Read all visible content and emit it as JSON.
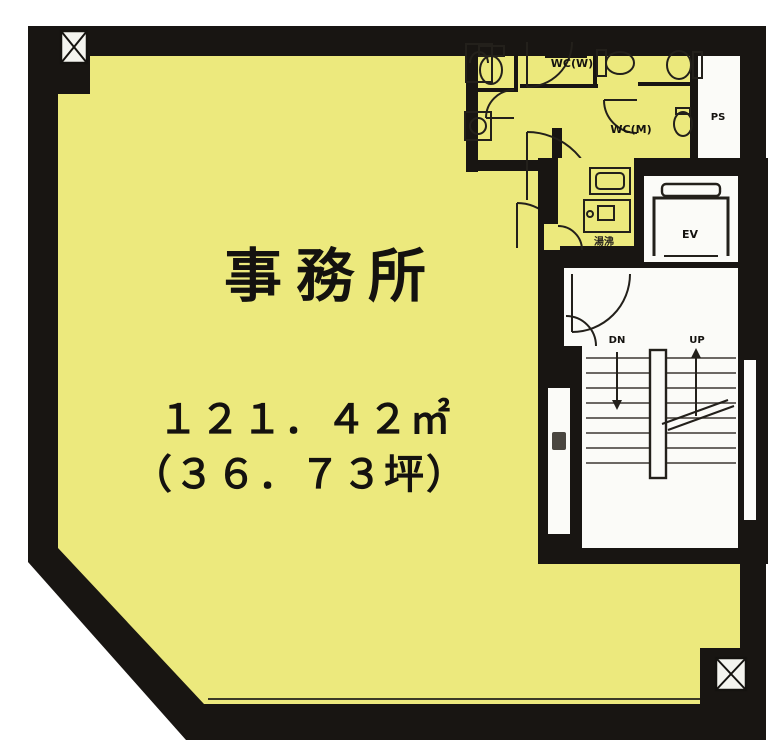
{
  "plan": {
    "room_label": "事務所",
    "area_sqm": "１２１．４２㎡",
    "area_tsubo": "（３６．７３坪）",
    "labels": {
      "wc_women": "WC(W)",
      "wc_men": "WC(M)",
      "elevator": "EV",
      "pipe_space": "PS",
      "stairs_down": "DN",
      "stairs_up": "UP",
      "kitchenette": "湯沸"
    },
    "colors": {
      "office_fill": "#ece97d",
      "wall": "#181512",
      "common_area": "#fbfbf8"
    }
  }
}
